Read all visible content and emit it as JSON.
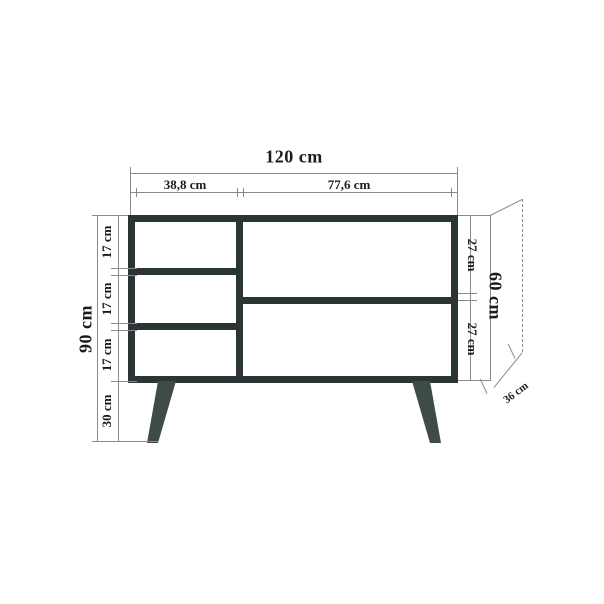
{
  "drawing": {
    "object": "sideboard-technical-drawing",
    "view": "front elevation with depth projection"
  },
  "dimensions": {
    "total_width": "120 cm",
    "left_section_width": "38,8 cm",
    "right_section_width": "77,6 cm",
    "total_height": "90 cm",
    "left_shelf_heights": [
      "17 cm",
      "17 cm",
      "17 cm"
    ],
    "leg_height": "30 cm",
    "right_compartment_heights": [
      "27 cm",
      "27 cm"
    ],
    "body_height": "60 cm",
    "depth": "36 cm"
  },
  "colors": {
    "carcass": "#2b3536",
    "legs": "#3e4b49",
    "dimension_lines": "#8a8a8a",
    "text": "#1c1c1c",
    "background": "#ffffff"
  }
}
